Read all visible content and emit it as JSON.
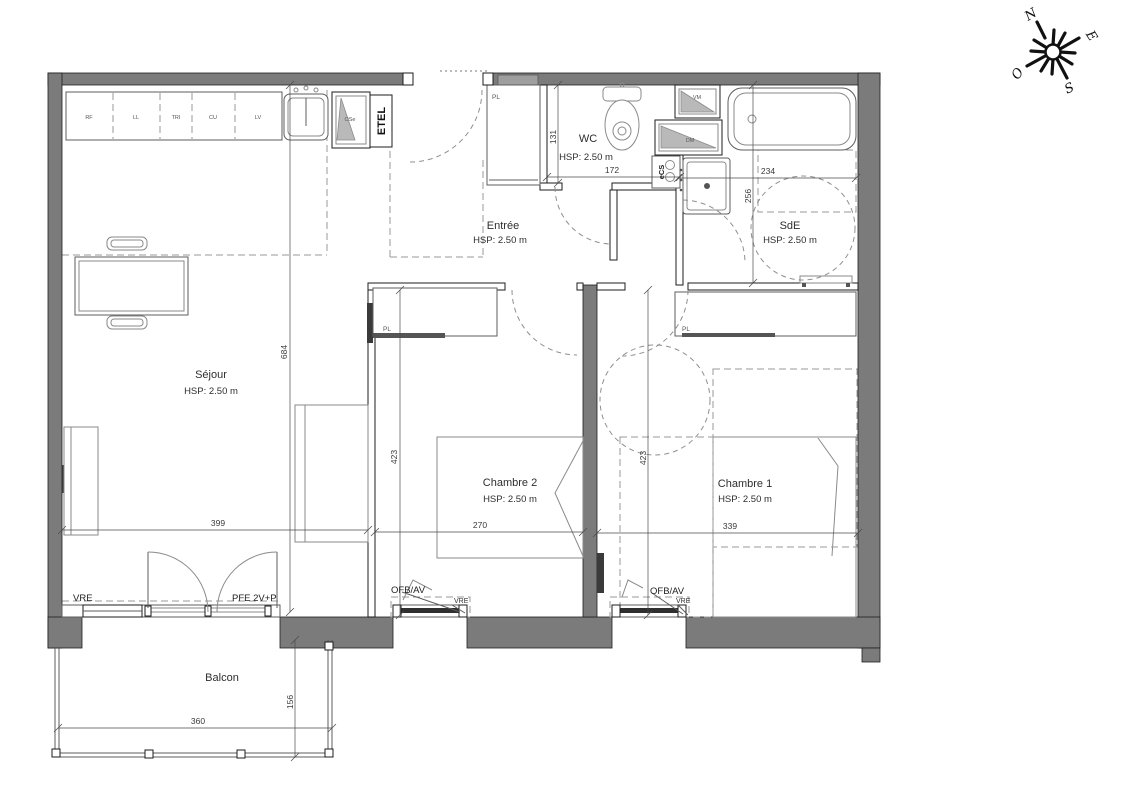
{
  "compass": {
    "north": "N",
    "east": "E",
    "south": "S",
    "west": "O"
  },
  "rooms": {
    "sejour": {
      "name": "Séjour",
      "hsp": "HSP: 2.50 m"
    },
    "entree": {
      "name": "Entrée",
      "hsp": "HSP: 2.50 m"
    },
    "wc": {
      "name": "WC",
      "hsp": "HSP: 2.50 m"
    },
    "sde": {
      "name": "SdE",
      "hsp": "HSP: 2.50 m"
    },
    "chambre1": {
      "name": "Chambre 1",
      "hsp": "HSP: 2.50 m"
    },
    "chambre2": {
      "name": "Chambre 2",
      "hsp": "HSP: 2.50 m"
    },
    "balcon": {
      "name": "Balcon"
    }
  },
  "kitchen": {
    "units": [
      "RF",
      "LL",
      "TRI",
      "CU",
      "LV"
    ],
    "etel_label": "ETEL",
    "shaft_label": "OSe"
  },
  "equipment": {
    "water_heater": "eCS",
    "duct_top": "VM",
    "duct_bottom": "DM",
    "closet": "PL"
  },
  "openings": {
    "window_sejour": "VRE",
    "french_door": "PFE 2V+P",
    "bedroom_window": "OFB/AV",
    "shutter": "VRE"
  },
  "dimensions": {
    "sejour_h": "684",
    "sejour_w": "399",
    "ch2_h": "423",
    "ch2_w": "270",
    "ch1_h": "423",
    "ch1_w": "339",
    "wc_h": "131",
    "wc_w": "172",
    "sde_w": "234",
    "sde_h": "256",
    "balcon_w": "360",
    "balcon_d": "156"
  }
}
